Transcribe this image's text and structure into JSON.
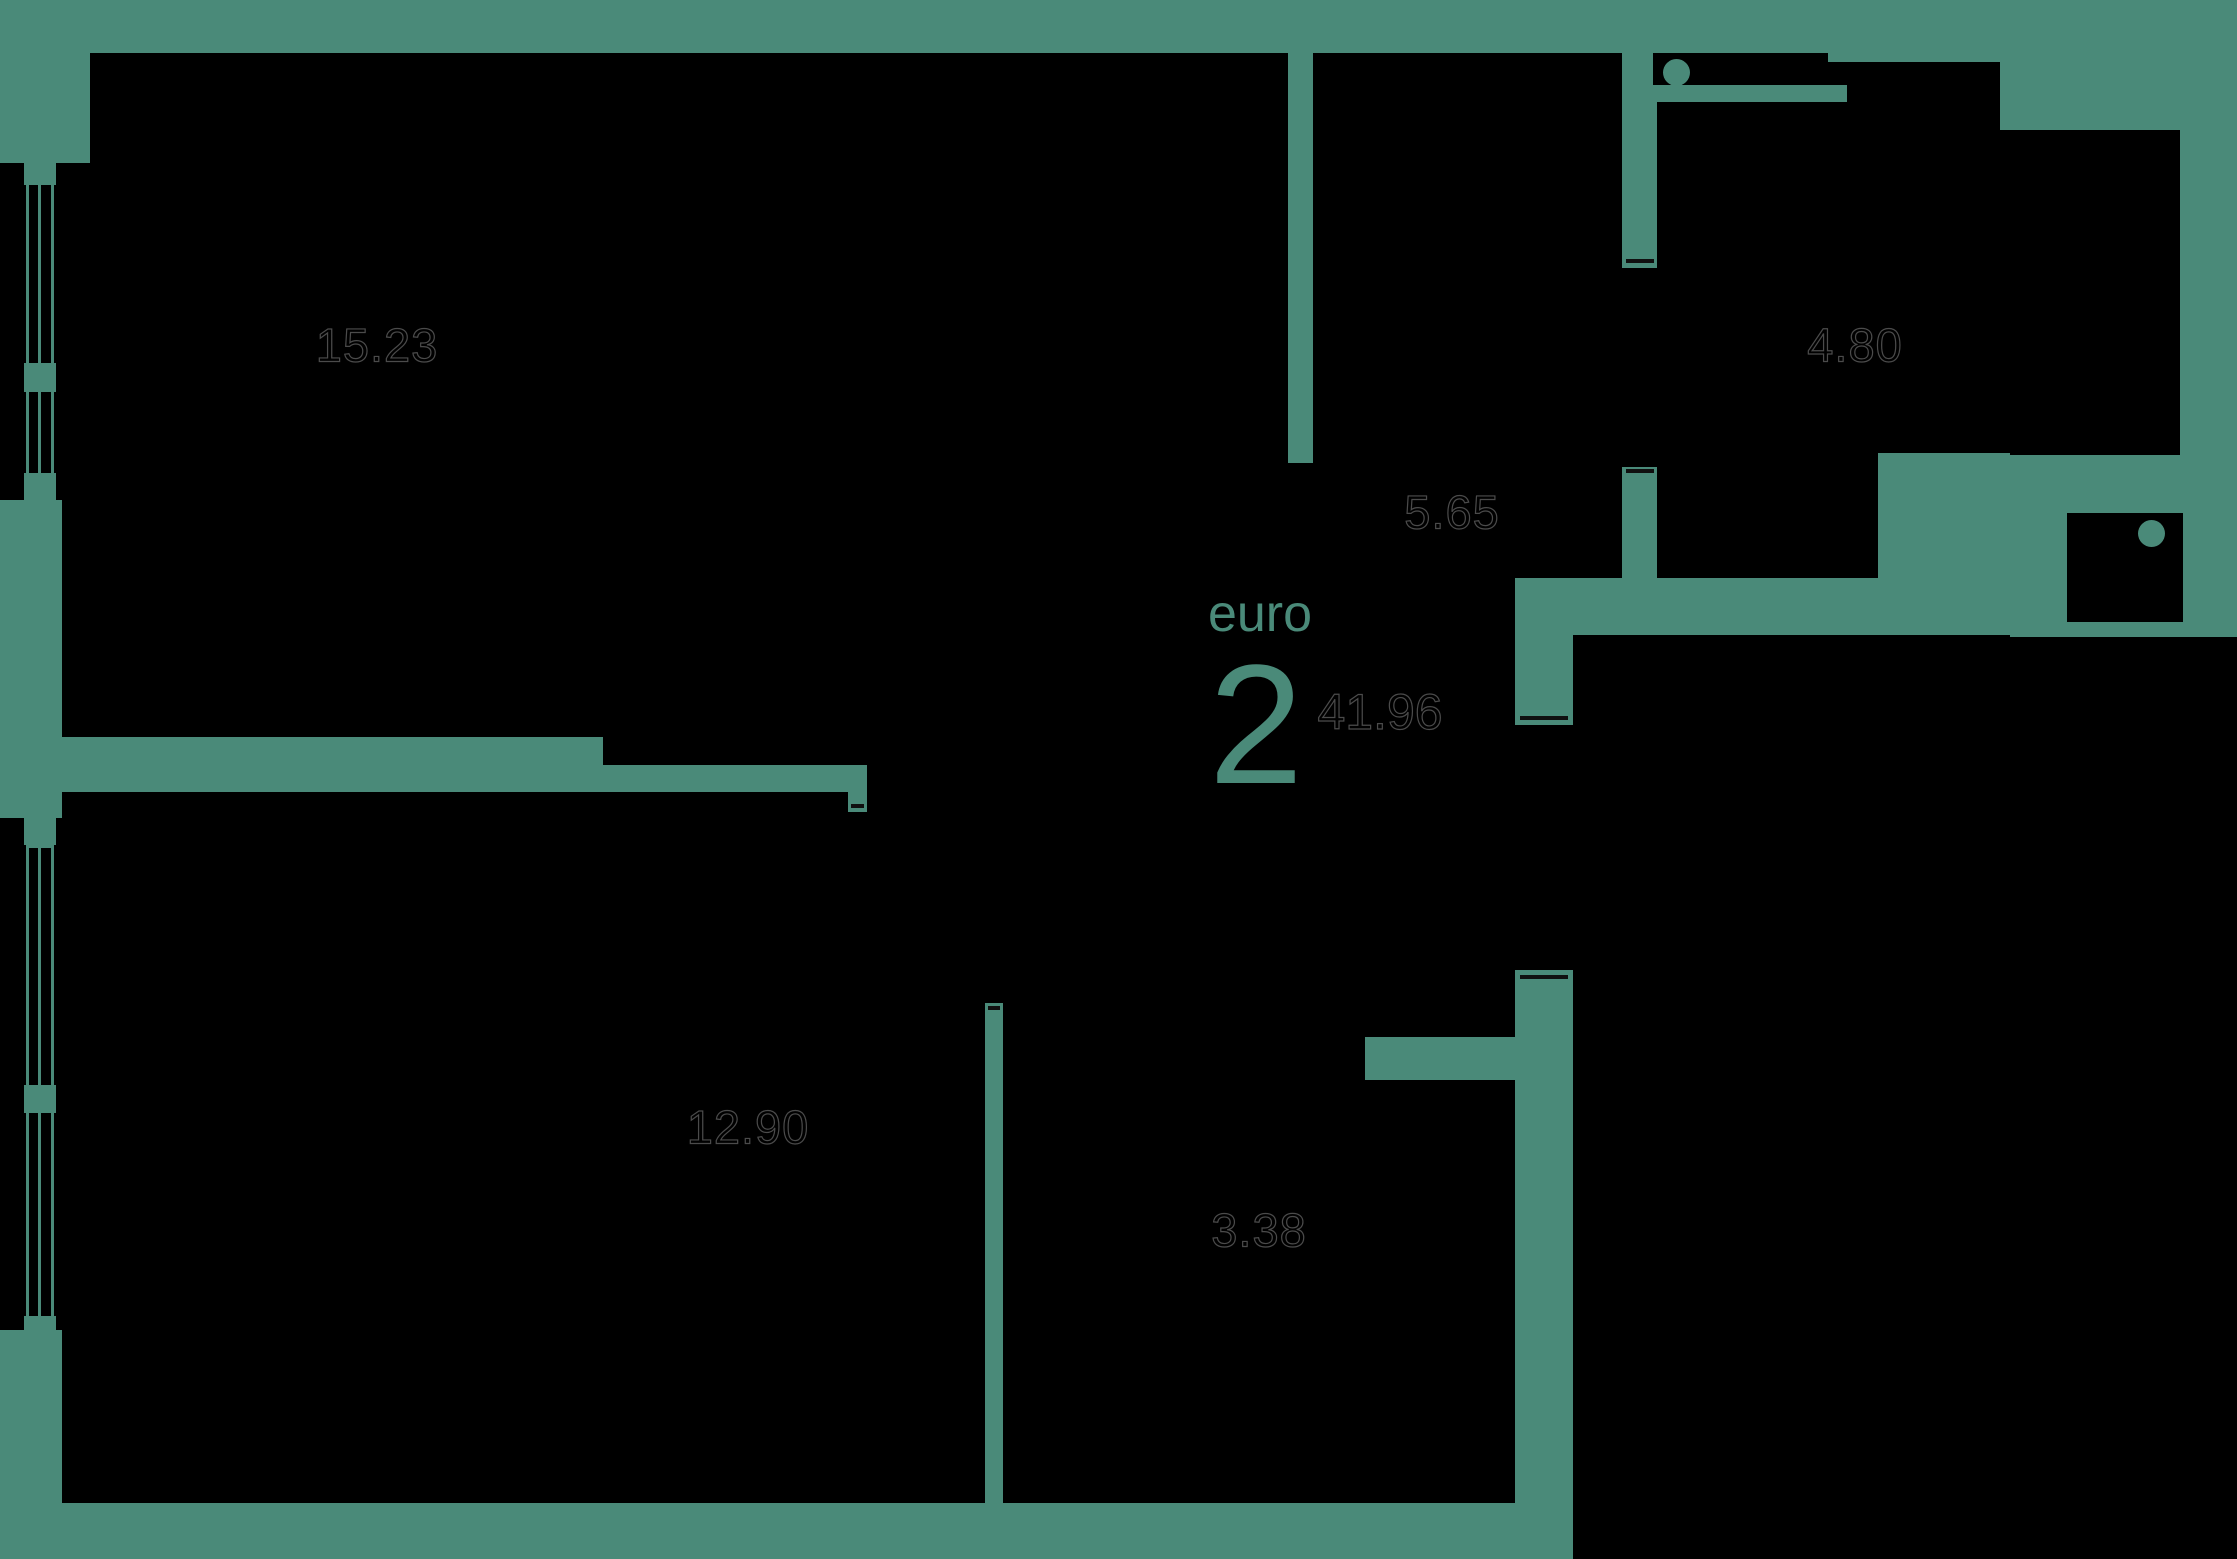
{
  "plan": {
    "title": {
      "type_label": "euro",
      "rooms_count": "2",
      "total_area": "41.96"
    },
    "rooms": [
      {
        "id": "living-room",
        "area": "15.23"
      },
      {
        "id": "hallway",
        "area": "5.65"
      },
      {
        "id": "kitchen",
        "area": "4.80"
      },
      {
        "id": "bedroom",
        "area": "12.90"
      },
      {
        "id": "bathroom",
        "area": "3.38"
      }
    ],
    "colors": {
      "background": "#000000",
      "wall": "#4a8a79",
      "accent_text": "#4a8a79",
      "area_text_outline": "#4b4b4b"
    }
  }
}
